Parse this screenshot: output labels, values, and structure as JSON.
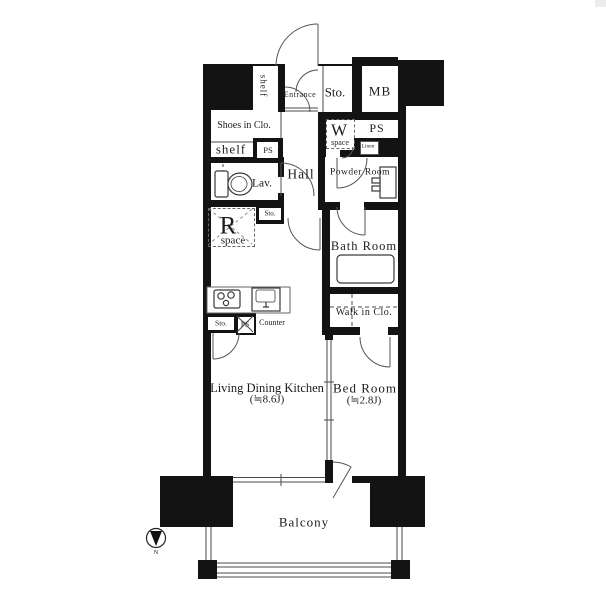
{
  "meta": {
    "type": "apartment-floor-plan",
    "background_color": "#ffffff",
    "wall_color": "#131313",
    "line_color": "#555555"
  },
  "labels": {
    "shelf_vertical": "shelf",
    "entrance": "Entrance",
    "sto_top": "Sto.",
    "mb": "MB",
    "shoes_in_closet": "Shoes in Clo.",
    "shelf": "shelf",
    "ps_hall": "PS",
    "w_space_letter": "W",
    "w_space_word": "space",
    "ps_upper_right": "PS",
    "linen": "Linen",
    "lav": "Lav.",
    "hall": "Hall",
    "powder_room": "Powder Room",
    "sto_hall": "Sto.",
    "r_space_letter": "R",
    "r_space_word": "space",
    "bath_room": "Bath Room",
    "walk_in_closet": "Walk in Clo.",
    "sto_kitchen": "Sto.",
    "ps_kitchen": "PS",
    "counter": "Counter",
    "ldk": "Living Dining Kitchen",
    "ldk_size": "(≒8.6J)",
    "bed_room": "Bed Room",
    "bed_room_size": "(≒2.8J)",
    "balcony": "Balcony",
    "compass_n": "N"
  }
}
